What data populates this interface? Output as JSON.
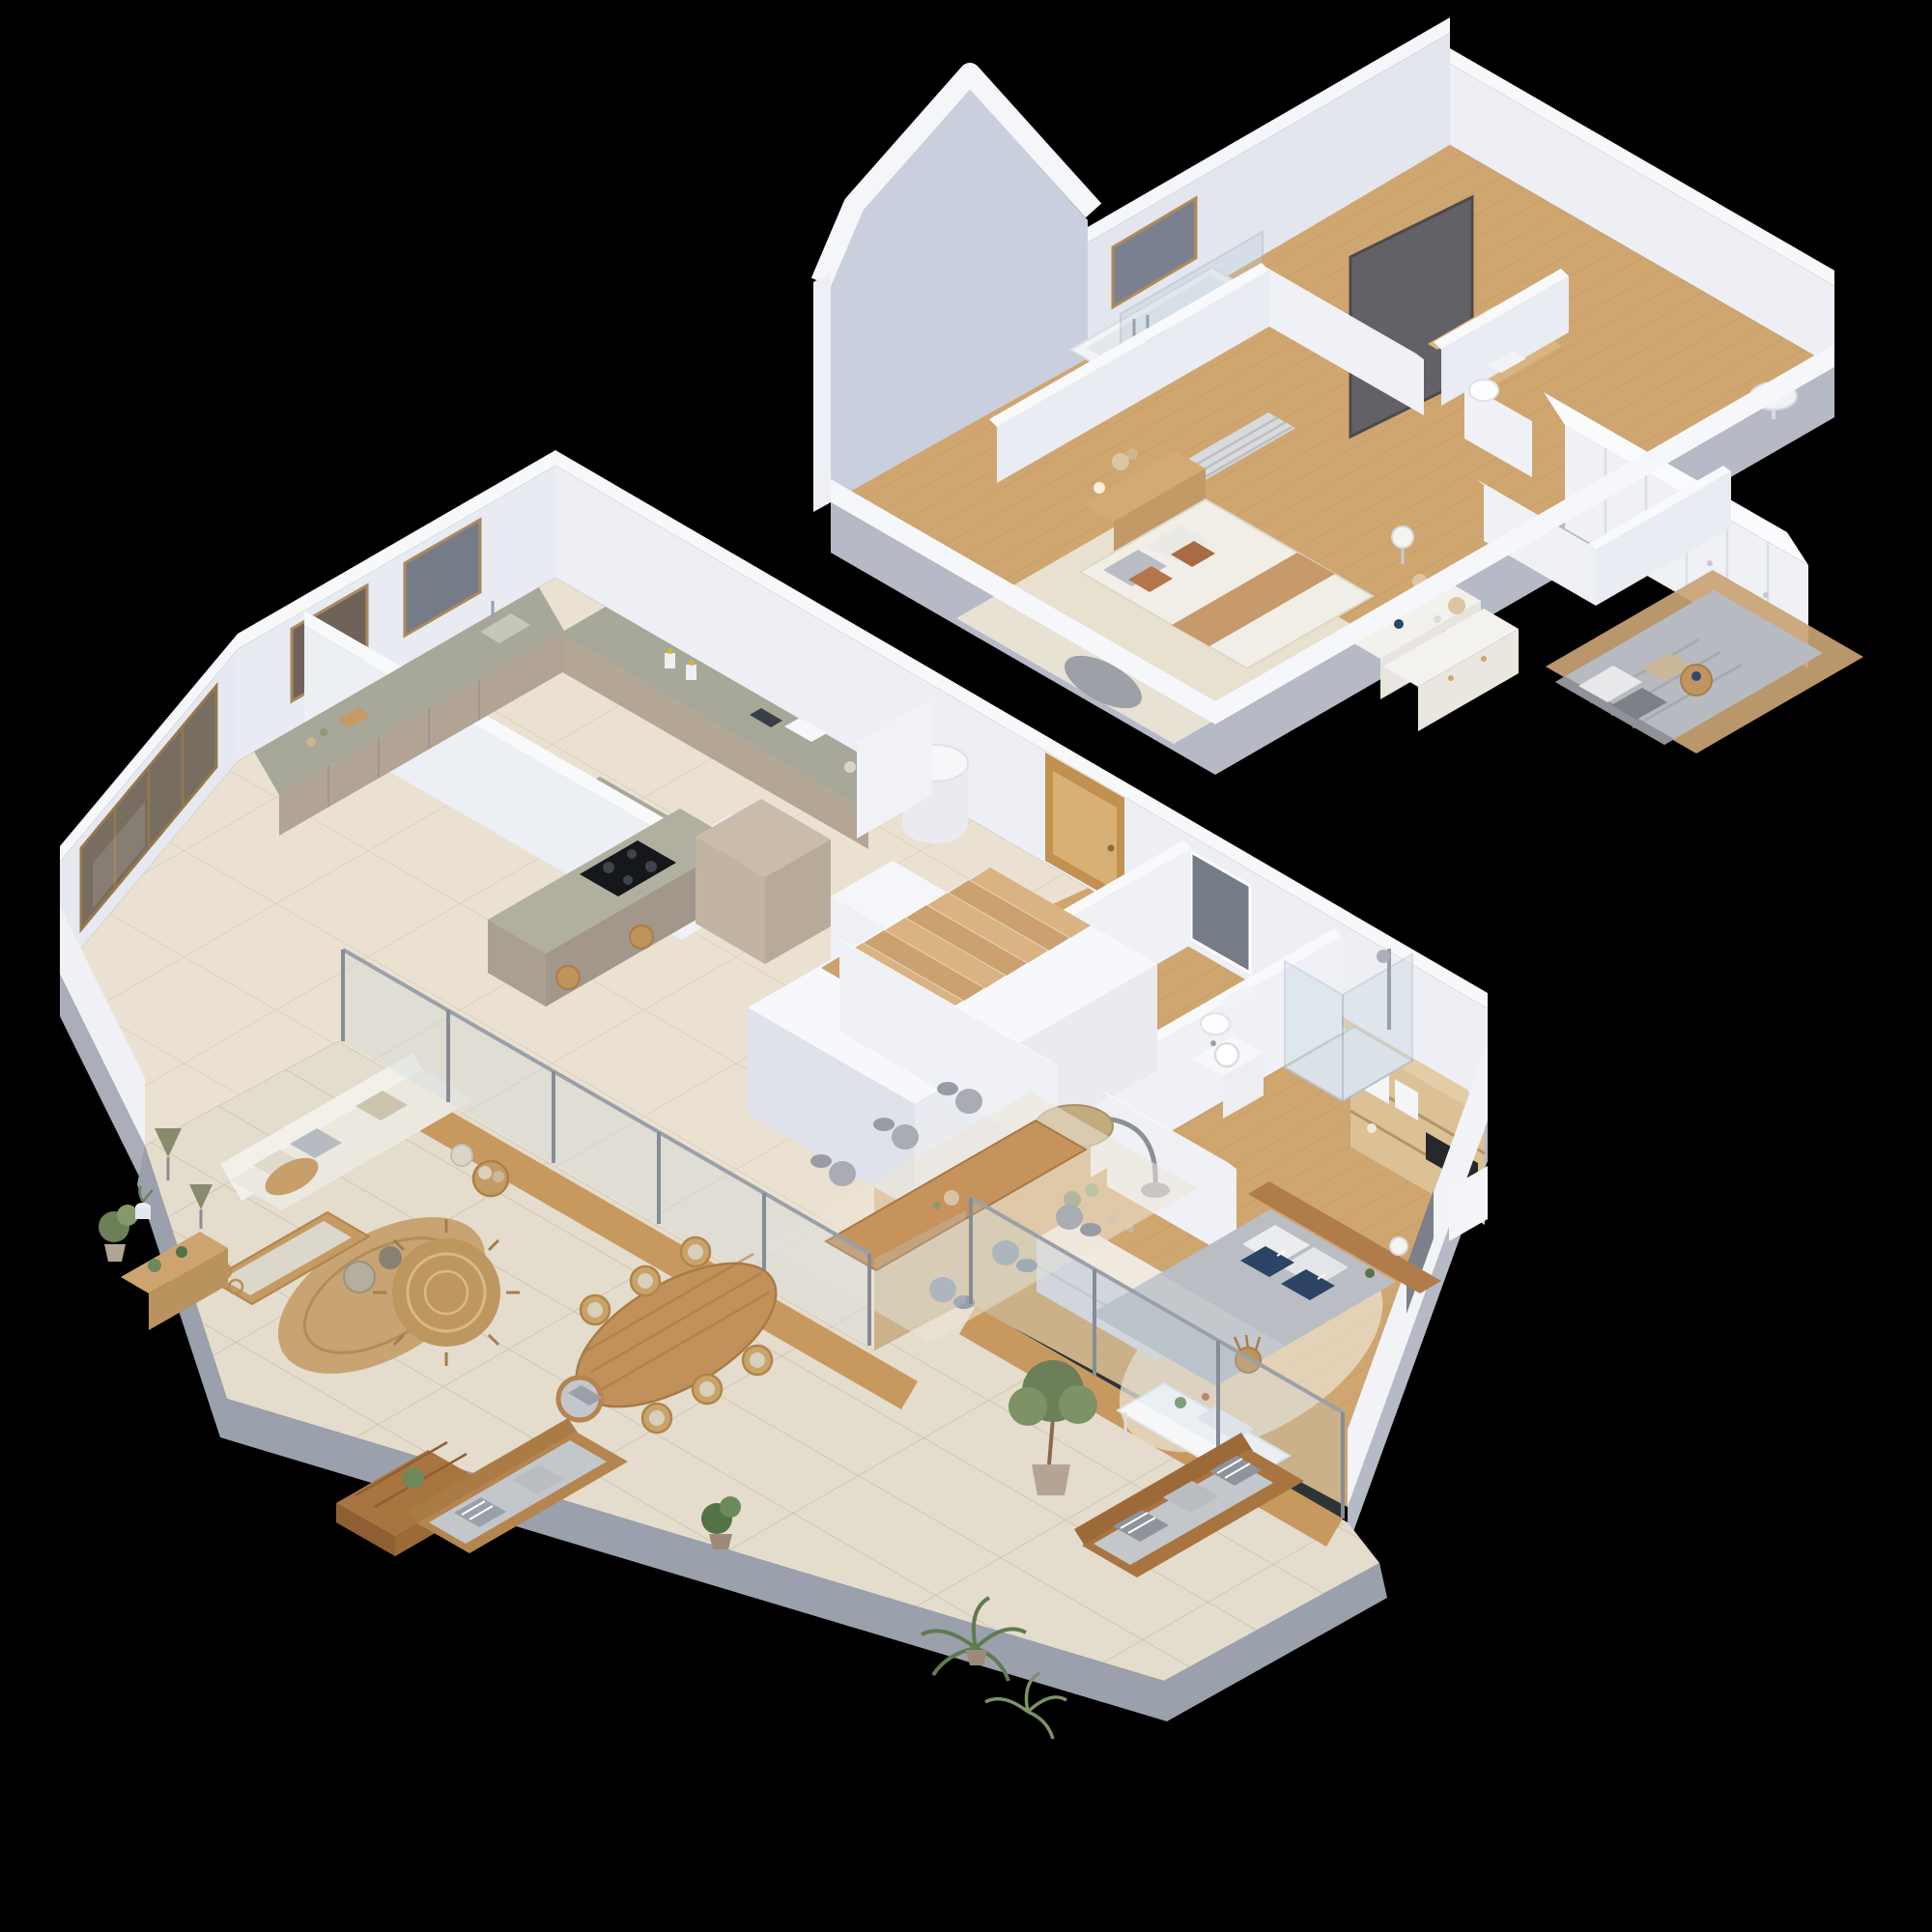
{
  "scene": {
    "description": "Photorealistic 3D isometric floor plan render of a two-storey apartment on a black background: upper attic floor (top right) with bathroom, two bedrooms and built-in wardrobes; ground floor (bottom left) with kitchen, utility room, entry hall, staircase, shower room, walk-in closet, bedroom, dining area, living room and a large wrap-around terrace.",
    "view": "isometric-3d-cutaway",
    "background": "#000000",
    "floors": [
      {
        "id": "upper-floor",
        "position": "top-right",
        "rooms": [
          {
            "name": "bathroom",
            "floor": "wood",
            "furniture": [
              "bathtub-with-glass-screen",
              "chrome-towel-rack",
              "blue-towel",
              "striped-bath-rug",
              "window"
            ]
          },
          {
            "name": "landing-hallway",
            "floor": "wood",
            "furniture": [
              "stair-opening",
              "dark-glass-stair-screen",
              "wood-steps"
            ]
          },
          {
            "name": "wc",
            "floor": "wood",
            "furniture": [
              "toilet",
              "round-pedestal-table"
            ]
          },
          {
            "name": "bedroom-1",
            "floor": "wood",
            "furniture": [
              "double-bed-tan-throw",
              "gray-and-rust-pillows",
              "cream-area-rug",
              "wood-sideboard",
              "pampas-vase",
              "table-lamp",
              "white-dresser-gold-knobs",
              "gray-floor-throw"
            ]
          },
          {
            "name": "bedroom-2",
            "floor": "wood",
            "furniture": [
              "double-bed-striped-gray-duvet",
              "patterned-pillows",
              "jute-rug",
              "round-wood-side-table",
              "blue-candle",
              "white-dresser-decor",
              "built-in-white-wardrobes"
            ]
          }
        ],
        "wall_feature": "gabled-attic-wall"
      },
      {
        "id": "ground-floor",
        "position": "bottom-left",
        "rooms": [
          {
            "name": "utility-room",
            "floor": "stone-tile",
            "furniture": [
              "u-shaped-counter",
              "laundry-detergent-bottles",
              "iron-and-towels",
              "white-cylinder-boiler"
            ]
          },
          {
            "name": "kitchen",
            "floor": "stone-tile",
            "furniture": [
              "l-shaped-taupe-counter",
              "stone-worktop",
              "sink",
              "wall-windows",
              "island-with-induction-hob",
              "two-wood-stools",
              "tall-cabinet",
              "white-pantry-block",
              "decor-vases"
            ]
          },
          {
            "name": "entry-hall",
            "floor": "stone-tile",
            "furniture": [
              "wood-front-door",
              "jute-herringbone-mat"
            ]
          },
          {
            "name": "staircase",
            "floor": "wood",
            "furniture": [
              "wood-treads",
              "white-stair-enclosure"
            ]
          },
          {
            "name": "shower-room",
            "floor": "wood",
            "furniture": [
              "toilet",
              "round-basin-vanity",
              "glass-walk-in-shower",
              "window"
            ]
          },
          {
            "name": "walk-in-closet",
            "floor": "wood",
            "furniture": [
              "open-wood-shelving",
              "hanging-white-shirts",
              "hanging-dark-clothes",
              "folded-linen",
              "shoes"
            ]
          },
          {
            "name": "bedroom-3",
            "floor": "wood",
            "furniture": [
              "double-bed-gray-bedding",
              "navy-accent-pillows",
              "wood-headboard-unit",
              "oval-cream-rug",
              "white-desk",
              "spindle-wood-chair",
              "gray-sideboard-console",
              "arc-floor-lamp",
              "wall-bench"
            ]
          },
          {
            "name": "dining-area",
            "floor": "stone-tile",
            "furniture": [
              "wood-dining-table",
              "six-gray-chairs",
              "pampas-centerpiece",
              "pale-area-rug"
            ]
          },
          {
            "name": "living-room",
            "floor": "stone-tile",
            "furniture": [
              "cream-three-seat-sofa",
              "tan-throw",
              "rattan-daybed",
              "two-round-jute-rugs",
              "round-coffee-tables",
              "pillow-basket",
              "olive-cone-floor-lamps",
              "potted-plant",
              "wood-console",
              "long-angled-panoramic-window"
            ]
          },
          {
            "name": "terrace",
            "floor": "outdoor-tile",
            "furniture": [
              "glass-balustrade",
              "sliding-glass-walls",
              "wood-deck-strips",
              "oval-outdoor-dining-table",
              "six-rattan-chairs",
              "wood-lounge-sofa",
              "lounge-armchair",
              "square-slat-coffee-table",
              "outdoor-sofa-striped-cushions",
              "potted-olive-tree",
              "palm-plants",
              "leafy-plants"
            ]
          }
        ]
      }
    ],
    "palette": {
      "background": "#000000",
      "wall_white": "#f6f7fa",
      "wall_face": "#e9ecf2",
      "gable_lavender": "#c9cfdd",
      "slab_edge": "#b6bac6",
      "wood_floor": "#cfa66f",
      "wood_plank_line": "#b98e58",
      "stone_tile": "#eae1d2",
      "terrace_tile": "#e4dccc",
      "counter_taupe": "#b3a695",
      "worktop_stone": "#a7a79a",
      "hob_black": "#16171b",
      "glass_blue": "#bcd2dc",
      "dark_window": "#767b88",
      "sofa_cream": "#ebe9df",
      "cushion_gray": "#c3c7cc",
      "navy_accent": "#2c4465",
      "towel_blue": "#2d5d95",
      "rust_accent": "#b5764a",
      "tan_throw": "#c79f6b",
      "jute": "#c7a471",
      "furniture_wood": "#c6935c",
      "outdoor_wood": "#a8743f",
      "plant_green": "#6d7f58"
    }
  }
}
